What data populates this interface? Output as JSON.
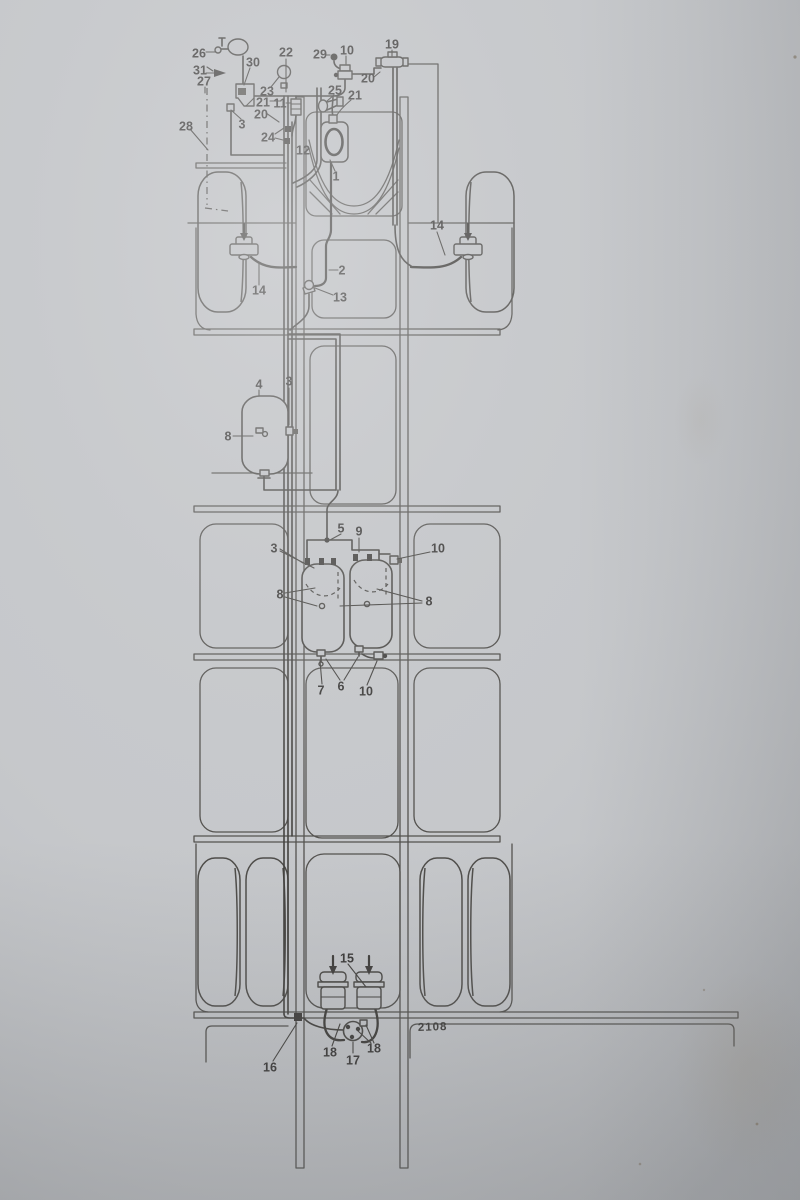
{
  "figure": {
    "kind": "printed-technical-diagram-photo",
    "drawing_number": "2108"
  },
  "colors": {
    "paper": "#c6c8cb",
    "line": "#3a3834",
    "label": "#282624"
  },
  "callouts": {
    "c26": "26",
    "c31": "31",
    "c27": "27",
    "c30": "30",
    "c28": "28",
    "c3a": "3",
    "c22": "22",
    "c23": "23",
    "c21b": "21",
    "c20b": "20",
    "c11": "11",
    "c24": "24",
    "c12": "12",
    "c29": "29",
    "c10a": "10",
    "c19": "19",
    "c20a": "20",
    "c25": "25",
    "c21a": "21",
    "c1": "1",
    "c2": "2",
    "c13": "13",
    "c14a": "14",
    "c14b": "14",
    "c4": "4",
    "c3b": "3",
    "c8a": "8",
    "c5": "5",
    "c9": "9",
    "c3c": "3",
    "c10b": "10",
    "c8b": "8",
    "c8c": "8",
    "c7": "7",
    "c6": "6",
    "c10c": "10",
    "c15": "15",
    "c18a": "18",
    "c17": "17",
    "c18b": "18",
    "c16": "16"
  }
}
